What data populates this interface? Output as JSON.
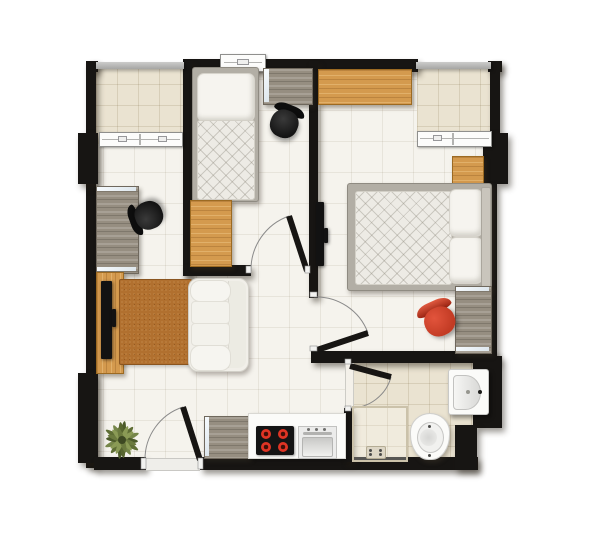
{
  "scene": {
    "type": "apartment-floor-plan",
    "view": "top-down",
    "rooms": [
      {
        "name": "balcony-left",
        "floor": "warm-tile",
        "furniture": []
      },
      {
        "name": "bedroom-1",
        "floor": "tile",
        "furniture": [
          "single-bed",
          "pillow",
          "quilted-duvet",
          "gray-sideboard",
          "office-chair",
          "wooden-dresser"
        ]
      },
      {
        "name": "bedroom-2",
        "floor": "tile",
        "furniture": [
          "double-bed",
          "two-pillows",
          "wooden-wardrobe",
          "wooden-nightstand",
          "desk",
          "red-chair",
          "wall-mounted-tv"
        ]
      },
      {
        "name": "balcony-right",
        "floor": "warm-tile",
        "furniture": []
      },
      {
        "name": "study-nook",
        "floor": "tile",
        "furniture": [
          "desk",
          "office-chair"
        ]
      },
      {
        "name": "living-room",
        "floor": "tile",
        "furniture": [
          "rug",
          "sofa",
          "tv-stand",
          "tv",
          "potted-plant"
        ]
      },
      {
        "name": "kitchen",
        "floor": "tile",
        "furniture": [
          "wooden-cabinet",
          "counter",
          "cooktop-4-burners",
          "kitchen-sink"
        ]
      },
      {
        "name": "bathroom",
        "floor": "warm-tile",
        "furniture": [
          "shower-enclosure",
          "floor-drain",
          "toilet",
          "washbasin"
        ]
      }
    ],
    "openings": {
      "doors": [
        "bedroom-1-door",
        "bedroom-2-door",
        "bathroom-door",
        "entrance-door"
      ],
      "windows": [
        "balcony-left-window",
        "bedroom-1-window",
        "balcony-right-window"
      ]
    }
  },
  "colors": {
    "wall": "#171513",
    "rail": "#a6a6a4",
    "floor": "#f5f3ed",
    "warm_floor": "#eae3d1",
    "wood": "#d49a4e",
    "graywood": "#968e81",
    "rug": "#b1702f",
    "sofa": "#f1efe9",
    "bedframe": "#b2aea5",
    "mattress": "#edebe5",
    "red_chair": "#c23b24",
    "burner": "#e03424",
    "plant": "#66743a",
    "silver": "#dde6ec",
    "arc": "#8a8a8a"
  }
}
